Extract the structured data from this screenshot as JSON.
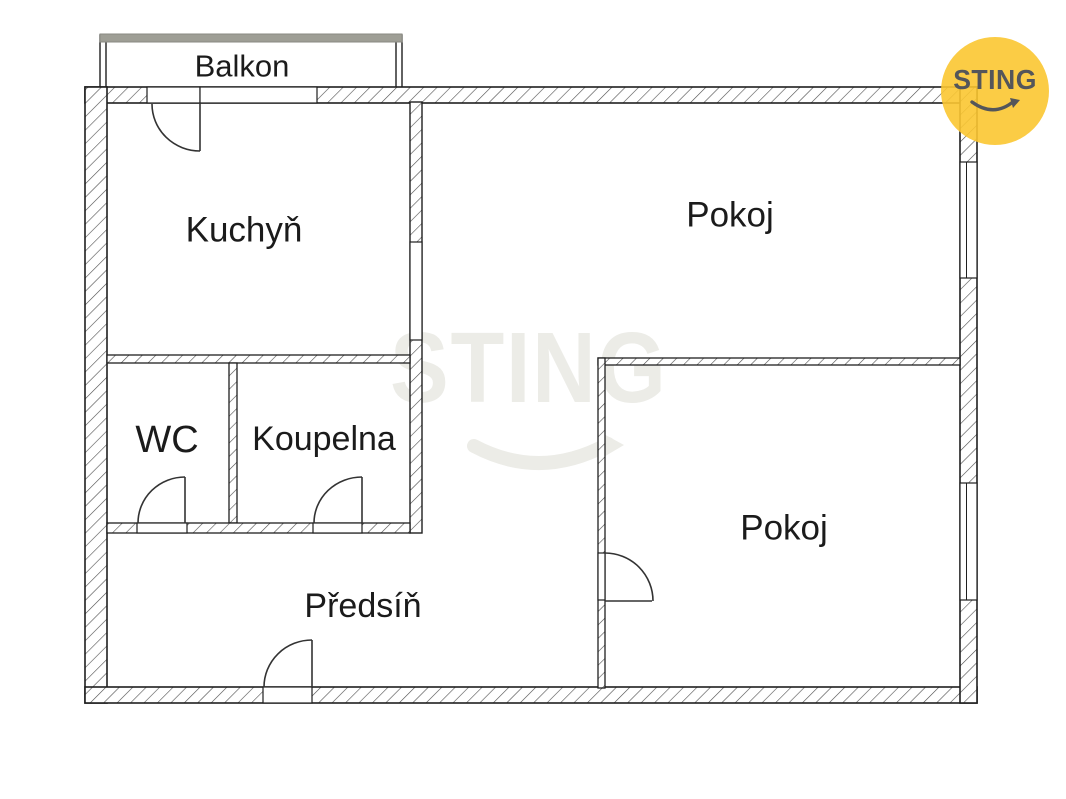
{
  "document": {
    "type": "floor-plan",
    "background_color": "#FFFFFF"
  },
  "branding": {
    "logo_text": "STING",
    "watermark_text": "STING",
    "logo_circle_color": "#FBC631",
    "logo_text_color": "#54565A",
    "watermark_color": "#ECECE7"
  },
  "floor_plan": {
    "wall_outline_color": "#1F1F1F",
    "hatch_line_color": "#4D4D4D",
    "balcony_rail_color": "#9E9E95",
    "door_line_color": "#333333",
    "rooms": [
      {
        "id": "balkon",
        "label": "Balkon"
      },
      {
        "id": "kuchyn",
        "label": "Kuchyň"
      },
      {
        "id": "pokoj-top",
        "label": "Pokoj"
      },
      {
        "id": "wc",
        "label": "WC"
      },
      {
        "id": "koupelna",
        "label": "Koupelna"
      },
      {
        "id": "predsin",
        "label": "Předsíň"
      },
      {
        "id": "pokoj-bottom",
        "label": "Pokoj"
      }
    ],
    "features": {
      "doors": [
        "balcony-door",
        "wc-door",
        "koupelna-door",
        "entrance-door",
        "pokoj-bottom-door"
      ],
      "windows": [
        "top-wall-window",
        "right-wall-window-upper",
        "right-wall-window-lower"
      ],
      "openings": [
        "kitchen-to-room-opening",
        "hall-to-room-passage"
      ]
    }
  }
}
